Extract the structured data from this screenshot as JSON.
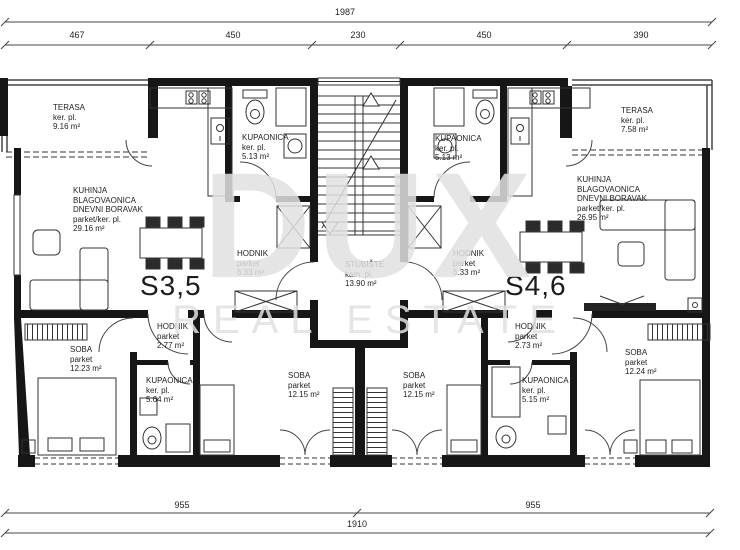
{
  "watermark": {
    "brand": "DUX",
    "tagline": "REAL ESTATE"
  },
  "dimensions": {
    "top_total": "1987",
    "top_segments": [
      "467",
      "450",
      "230",
      "450",
      "390"
    ],
    "bottom_segments": [
      "955",
      "955"
    ],
    "bottom_total": "1910"
  },
  "units": {
    "left": {
      "id": "S3,5",
      "terrace": {
        "name": "TERASA",
        "finish": "ker. pl.",
        "area": "9.16 m²"
      },
      "living": {
        "l1": "KUHINJA",
        "l2": "BLAGOVAONICA",
        "l3": "DNEVNI BORAVAK",
        "finish": "parket/ker. pl.",
        "area": "29.16 m²"
      },
      "bath_top": {
        "name": "KUPAONICA",
        "finish": "ker. pl.",
        "area": "5.13 m²"
      },
      "hall": {
        "name": "HODNIK",
        "finish": "parket",
        "area": "6.33 m²"
      },
      "hall2": {
        "name": "HODNIK",
        "finish": "parket",
        "area": "2.77 m²"
      },
      "bath_bottom": {
        "name": "KUPAONICA",
        "finish": "ker. pl.",
        "area": "5.64 m²"
      },
      "bedroom1": {
        "name": "SOBA",
        "finish": "parket",
        "area": "12.23 m²"
      },
      "bedroom2": {
        "name": "SOBA",
        "finish": "parket",
        "area": "12.15 m²"
      }
    },
    "right": {
      "id": "S4,6",
      "terrace": {
        "name": "TERASA",
        "finish": "ker. pl.",
        "area": "7.58 m²"
      },
      "living": {
        "l1": "KUHINJA",
        "l2": "BLAGOVAONICA",
        "l3": "DNEVNI BORAVAK",
        "finish": "parket/ker. pl.",
        "area": "26.95 m²"
      },
      "bath_top": {
        "name": "KUPAONICA",
        "finish": "ker. pl.",
        "area": "5.13 m²"
      },
      "hall": {
        "name": "HODNIK",
        "finish": "parket",
        "area": "6.33 m²"
      },
      "hall2": {
        "name": "HODNIK",
        "finish": "parket",
        "area": "2.73 m²"
      },
      "bath_bottom": {
        "name": "KUPAONICA",
        "finish": "ker. pl.",
        "area": "5.15 m²"
      },
      "bedroom2": {
        "name": "SOBA",
        "finish": "parket",
        "area": "12.15 m²"
      },
      "bedroom3": {
        "name": "SOBA",
        "finish": "parket",
        "area": "12.24 m²"
      }
    },
    "stairwell": {
      "name": "STUBIŠTE",
      "finish": "kam. pl.",
      "area": "13.90 m²"
    }
  },
  "colors": {
    "wall": "#161616",
    "line": "#333333",
    "watermark_gray": "#e0e0e0"
  }
}
